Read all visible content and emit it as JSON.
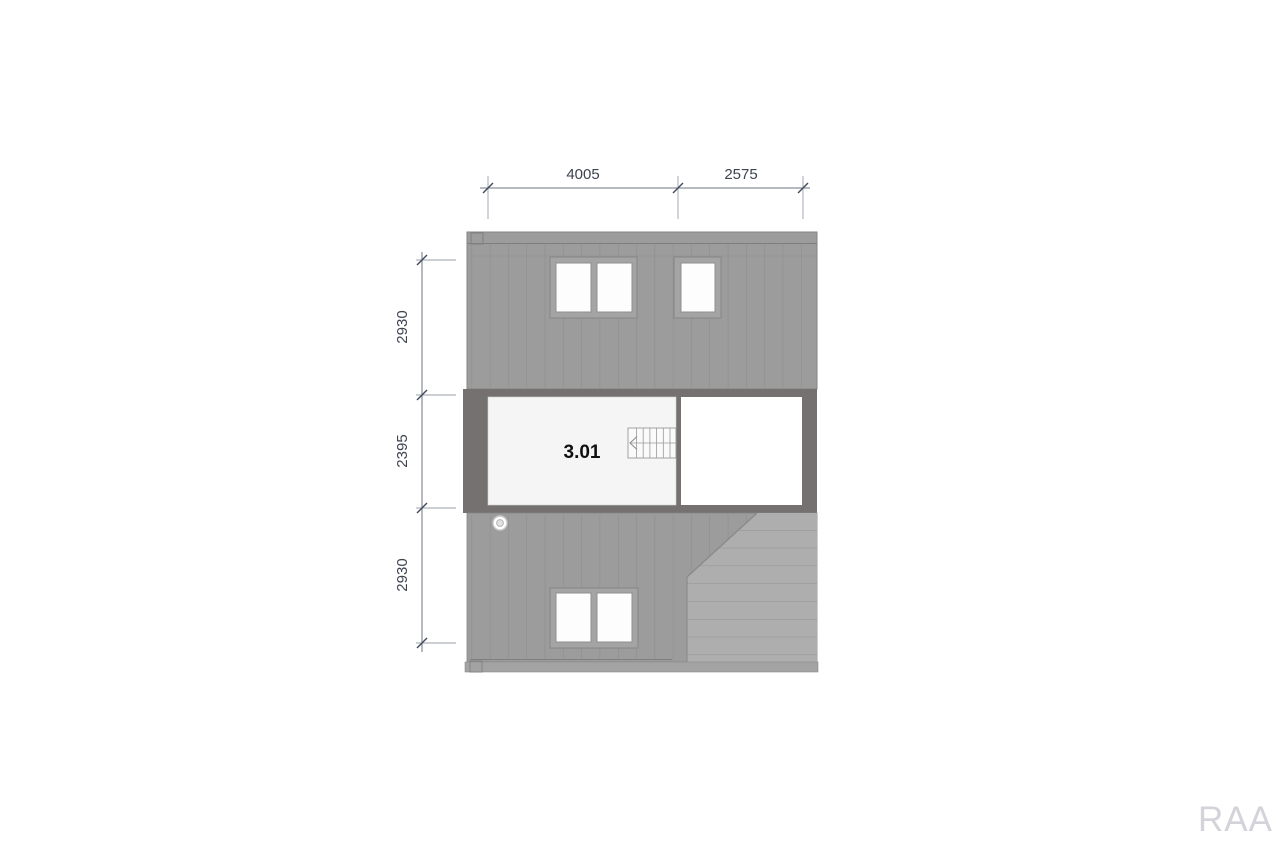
{
  "drawing": {
    "room": {
      "number": "3.01"
    },
    "dimensions": {
      "top": {
        "a": "4005",
        "b": "2575"
      },
      "left": {
        "a": "2930",
        "b": "2395",
        "c": "2930"
      }
    },
    "watermark": "RAA",
    "colors": {
      "wall_gray": "#9c9c9c",
      "plan_wall_gray": "#757170",
      "exterior_stair_gray": "#aeaeae",
      "room_floor": "#f5f5f6",
      "dimension_line": "#6e7682",
      "dimension_text": "#3d4450",
      "watermark_gray": "#d3d3d9"
    }
  }
}
